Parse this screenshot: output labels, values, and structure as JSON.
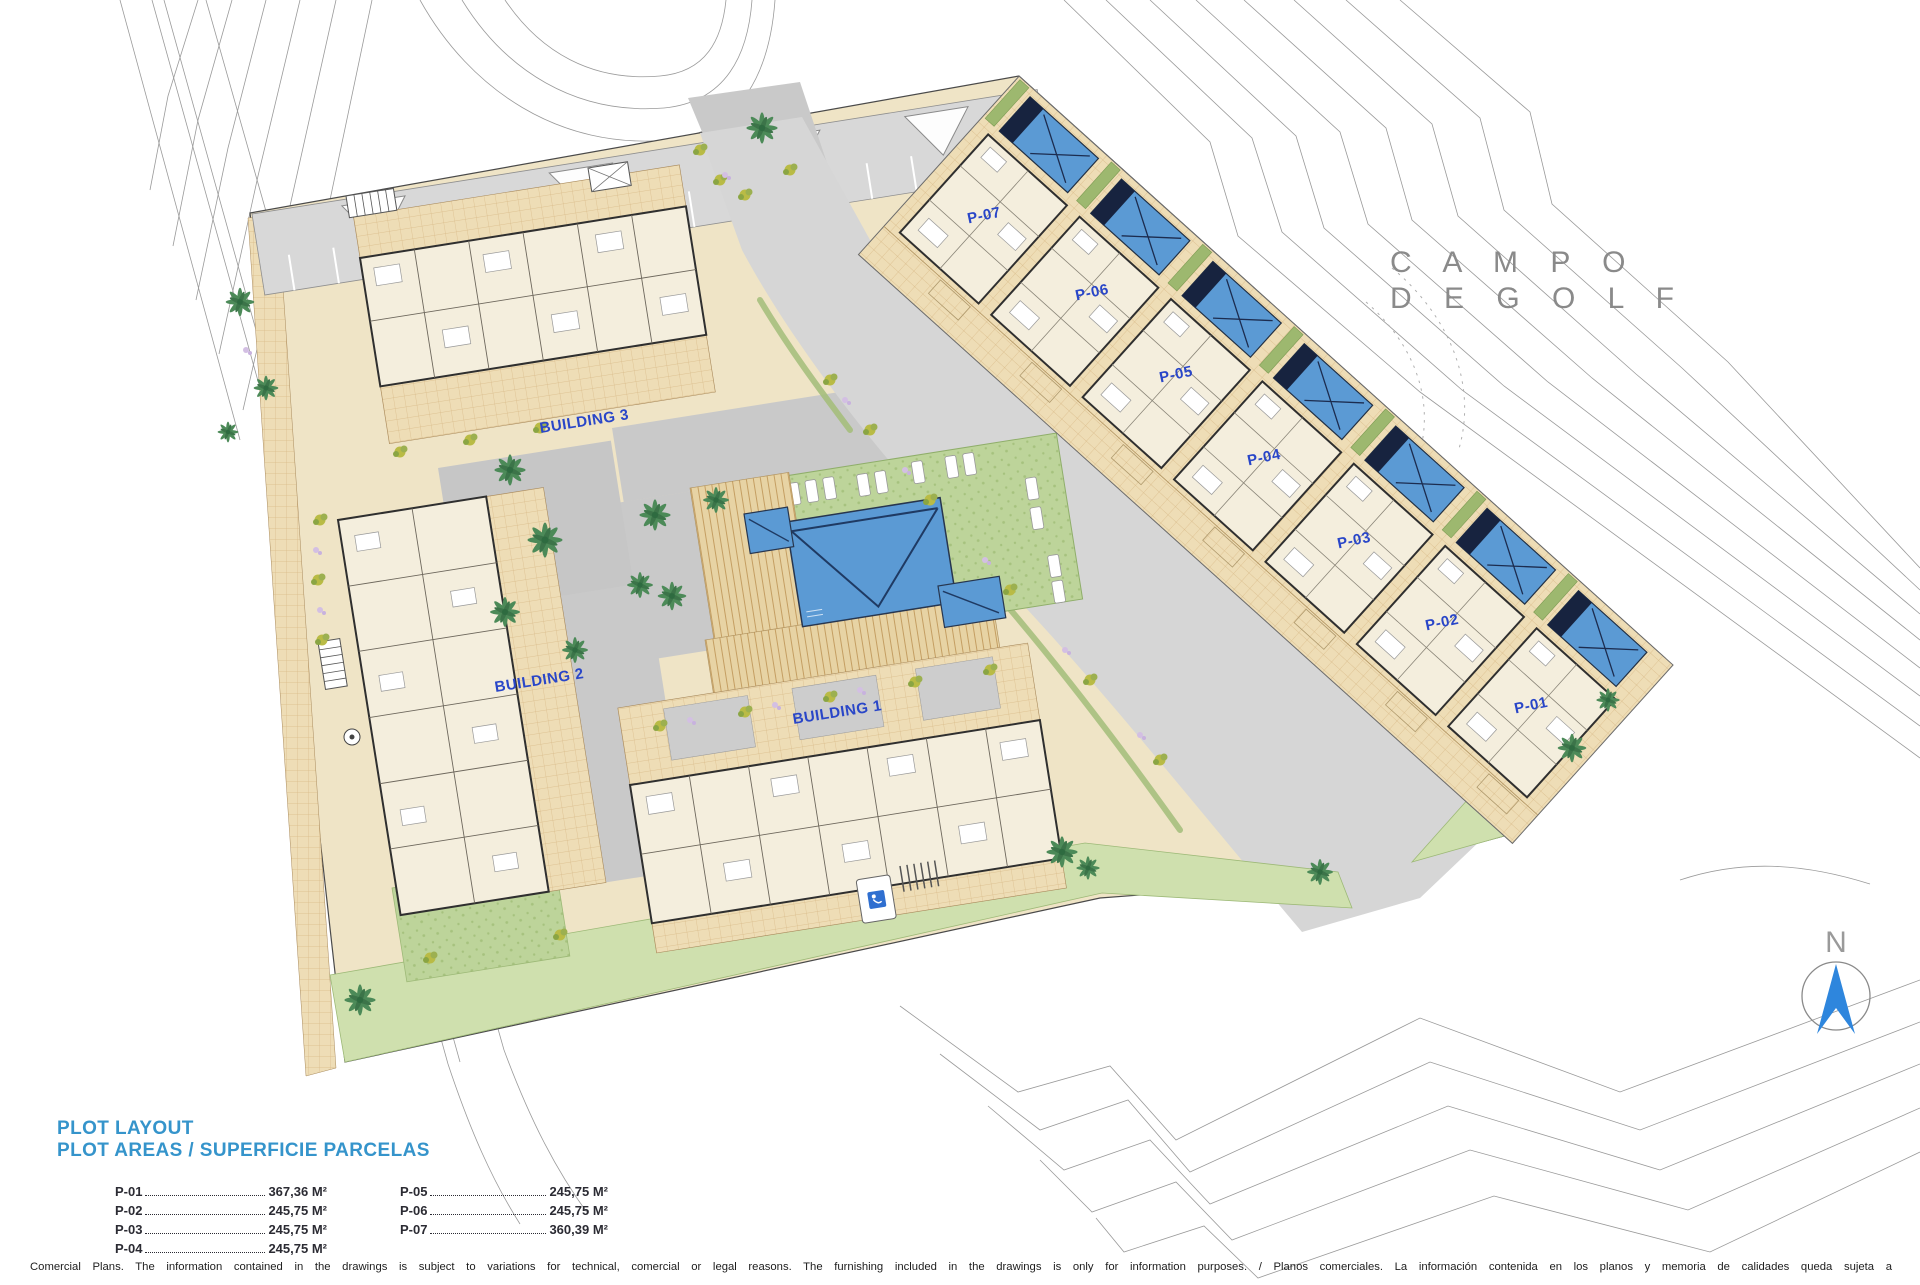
{
  "plan": {
    "golf_area_label": {
      "line1": "C A M P O",
      "line2": "D E   G O L F"
    },
    "buildings": [
      {
        "label": "BUILDING 3"
      },
      {
        "label": "BUILDING 2"
      },
      {
        "label": "BUILDING 1"
      }
    ],
    "plots": [
      {
        "label": "P-07"
      },
      {
        "label": "P-06"
      },
      {
        "label": "P-05"
      },
      {
        "label": "P-04"
      },
      {
        "label": "P-03"
      },
      {
        "label": "P-02"
      },
      {
        "label": "P-01"
      }
    ],
    "north_label": "N"
  },
  "legend": {
    "title_line1": "PLOT LAYOUT",
    "title_line2": "PLOT AREAS / SUPERFICIE PARCELAS",
    "columns": [
      [
        {
          "plot": "P-01",
          "area": "367,36 M²"
        },
        {
          "plot": "P-02",
          "area": "245,75 M²"
        },
        {
          "plot": "P-03",
          "area": "245,75 M²"
        },
        {
          "plot": "P-04",
          "area": "245,75 M²"
        }
      ],
      [
        {
          "plot": "P-05",
          "area": "245,75 M²"
        },
        {
          "plot": "P-06",
          "area": "245,75 M²"
        },
        {
          "plot": "P-07",
          "area": "360,39 M²"
        }
      ]
    ]
  },
  "footer": {
    "disclaimer": "Comercial Plans. The information contained in the drawings is subject to variations for technical, comercial or legal reasons. The furnishing included in the drawings is only for information purposes. / Planos comerciales. La información contenida en los planos y memoria de calidades queda sujeta a"
  },
  "colors": {
    "label_blue": "#2946c8",
    "legend_blue": "#3594cb",
    "pool_blue": "#5b9ad4",
    "paving_tan": "#eeddb6",
    "lawn_green": "#bdd49a",
    "road_gray": "#d6d6d6",
    "north_blue": "#2e86dd"
  }
}
